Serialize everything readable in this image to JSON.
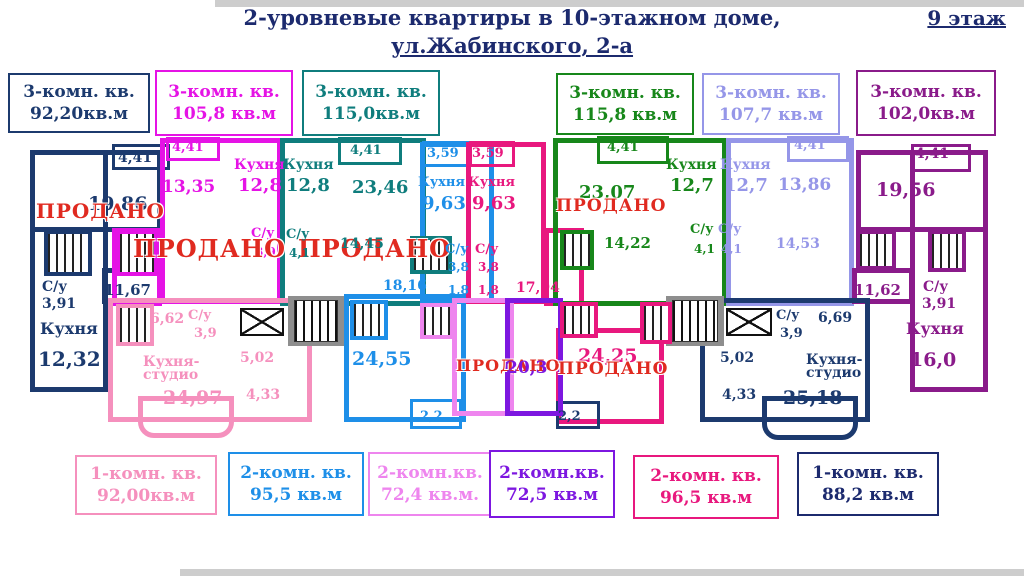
{
  "title": {
    "line1": "2-уровневые квартиры в 10-этажном доме,",
    "line2": "ул.Жабинского, 2-а",
    "floor_badge": "9 этаж"
  },
  "sold_text": "ПРОДАНО",
  "top_labels": [
    {
      "type": "3-комн. кв.",
      "area": "92,20кв.м",
      "color": "#1c3a6e"
    },
    {
      "type": "3-комн. кв.",
      "area": "105,8 кв.м",
      "color": "#e513e5"
    },
    {
      "type": "3-комн. кв.",
      "area": "115,0кв.м",
      "color": "#0f7d7d"
    },
    {
      "type": "3-комн. кв.",
      "area": "115,8 кв.м",
      "color": "#17871a"
    },
    {
      "type": "3-комн. кв.",
      "area": "107,7 кв.м",
      "color": "#9596e8"
    },
    {
      "type": "3-комн. кв.",
      "area": "102,0кв.м",
      "color": "#8a1b8a"
    }
  ],
  "bottom_labels": [
    {
      "type": "1-комн. кв.",
      "area": "92,00кв.м",
      "color": "#f590bd"
    },
    {
      "type": "2-комн. кв.",
      "area": "95,5 кв.м",
      "color": "#1e8fe8"
    },
    {
      "type": "2-комн.кв.",
      "area": "72,4 кв.м.",
      "color": "#ee85ee"
    },
    {
      "type": "2-комн.кв.",
      "area": "72,5 кв.м",
      "color": "#7d17e0"
    },
    {
      "type": "2-комн. кв.",
      "area": "96,5 кв.м",
      "color": "#e8187e"
    },
    {
      "type": "1-комн. кв.",
      "area": "88,2 кв.м",
      "color": "#1c2a6e"
    }
  ],
  "plan": {
    "colors": {
      "navy": "#1c3a6e",
      "magenta": "#e513e5",
      "teal": "#0f7d7d",
      "blue": "#1e8fe8",
      "crimson": "#e8187e",
      "green": "#17871a",
      "peri": "#9596e8",
      "purple": "#8a1b8a",
      "pink": "#f590bd",
      "orchid": "#ee85ee",
      "violet": "#7d17e0",
      "red": "#e02a20"
    },
    "labels": [
      {
        "t": "4,41",
        "c": "navy",
        "x": 118,
        "y": 150,
        "s": 14
      },
      {
        "t": "19,86",
        "c": "navy",
        "x": 88,
        "y": 193,
        "s": 19
      },
      {
        "t": "ПРОДАНО",
        "c": "red",
        "x": 36,
        "y": 199,
        "s": 20,
        "sold": true
      },
      {
        "t": "С/у",
        "c": "navy",
        "x": 42,
        "y": 279,
        "s": 14
      },
      {
        "t": "3,91",
        "c": "navy",
        "x": 42,
        "y": 296,
        "s": 14
      },
      {
        "t": "11,67",
        "c": "navy",
        "x": 104,
        "y": 281,
        "s": 15
      },
      {
        "t": "Кухня",
        "c": "navy",
        "x": 40,
        "y": 319,
        "s": 16
      },
      {
        "t": "12,32",
        "c": "navy",
        "x": 38,
        "y": 347,
        "s": 20
      },
      {
        "t": "4,41",
        "c": "magenta",
        "x": 172,
        "y": 140,
        "s": 13
      },
      {
        "t": "13,35",
        "c": "magenta",
        "x": 162,
        "y": 177,
        "s": 17
      },
      {
        "t": "Кухня",
        "c": "magenta",
        "x": 234,
        "y": 157,
        "s": 14
      },
      {
        "t": "12,8",
        "c": "magenta",
        "x": 238,
        "y": 175,
        "s": 18
      },
      {
        "t": "С/у",
        "c": "magenta",
        "x": 251,
        "y": 226,
        "s": 13
      },
      {
        "t": "3,9",
        "c": "magenta",
        "x": 255,
        "y": 245,
        "s": 12
      },
      {
        "t": "ПРОДАНО",
        "c": "red",
        "x": 133,
        "y": 234,
        "s": 24,
        "sold": true
      },
      {
        "t": "ПРОДАНО",
        "c": "red",
        "x": 298,
        "y": 234,
        "s": 24,
        "sold": true
      },
      {
        "t": "Кухня",
        "c": "teal",
        "x": 283,
        "y": 157,
        "s": 14
      },
      {
        "t": "12,8",
        "c": "teal",
        "x": 286,
        "y": 175,
        "s": 18
      },
      {
        "t": "4,41",
        "c": "teal",
        "x": 350,
        "y": 143,
        "s": 13
      },
      {
        "t": "23,46",
        "c": "teal",
        "x": 352,
        "y": 177,
        "s": 18
      },
      {
        "t": "С/у",
        "c": "teal",
        "x": 286,
        "y": 227,
        "s": 13
      },
      {
        "t": "4,1",
        "c": "teal",
        "x": 289,
        "y": 246,
        "s": 12
      },
      {
        "t": "14,45",
        "c": "teal",
        "x": 340,
        "y": 236,
        "s": 14
      },
      {
        "t": "3,59",
        "c": "blue",
        "x": 427,
        "y": 146,
        "s": 13
      },
      {
        "t": "Кухня",
        "c": "blue",
        "x": 418,
        "y": 175,
        "s": 13
      },
      {
        "t": "9,63",
        "c": "blue",
        "x": 422,
        "y": 193,
        "s": 18
      },
      {
        "t": "С/у",
        "c": "blue",
        "x": 445,
        "y": 242,
        "s": 13
      },
      {
        "t": "3,8",
        "c": "blue",
        "x": 448,
        "y": 260,
        "s": 12
      },
      {
        "t": "1,8",
        "c": "blue",
        "x": 448,
        "y": 283,
        "s": 12
      },
      {
        "t": "18,16",
        "c": "blue",
        "x": 383,
        "y": 278,
        "s": 14
      },
      {
        "t": "24,55",
        "c": "blue",
        "x": 352,
        "y": 348,
        "s": 19
      },
      {
        "t": "2,2",
        "c": "blue",
        "x": 420,
        "y": 409,
        "s": 13
      },
      {
        "t": "3,59",
        "c": "crimson",
        "x": 472,
        "y": 146,
        "s": 13
      },
      {
        "t": "Кухня",
        "c": "crimson",
        "x": 468,
        "y": 175,
        "s": 13
      },
      {
        "t": "9,63",
        "c": "crimson",
        "x": 472,
        "y": 193,
        "s": 18
      },
      {
        "t": "С/у",
        "c": "crimson",
        "x": 475,
        "y": 242,
        "s": 13
      },
      {
        "t": "3,8",
        "c": "crimson",
        "x": 478,
        "y": 260,
        "s": 12
      },
      {
        "t": "1,8",
        "c": "crimson",
        "x": 478,
        "y": 283,
        "s": 12
      },
      {
        "t": "17,94",
        "c": "crimson",
        "x": 516,
        "y": 280,
        "s": 14
      },
      {
        "t": "ПРОДАНО",
        "c": "red",
        "x": 456,
        "y": 356,
        "s": 16,
        "sold": true
      },
      {
        "t": "20,3",
        "c": "violet",
        "x": 506,
        "y": 358,
        "s": 17
      },
      {
        "t": "24,25",
        "c": "crimson",
        "x": 578,
        "y": 345,
        "s": 19
      },
      {
        "t": "ПРОДАНО",
        "c": "red",
        "x": 558,
        "y": 359,
        "s": 17,
        "sold": true
      },
      {
        "t": "2,2",
        "c": "navy",
        "x": 558,
        "y": 409,
        "s": 13
      },
      {
        "t": "4,41",
        "c": "green",
        "x": 607,
        "y": 140,
        "s": 13
      },
      {
        "t": "23,07",
        "c": "green",
        "x": 579,
        "y": 182,
        "s": 18
      },
      {
        "t": "ПРОДАНО",
        "c": "red",
        "x": 556,
        "y": 196,
        "s": 17,
        "sold": true
      },
      {
        "t": "Кухня",
        "c": "green",
        "x": 666,
        "y": 157,
        "s": 14
      },
      {
        "t": "12,7",
        "c": "green",
        "x": 670,
        "y": 175,
        "s": 18
      },
      {
        "t": "С/у",
        "c": "green",
        "x": 690,
        "y": 222,
        "s": 13
      },
      {
        "t": "4,1",
        "c": "green",
        "x": 694,
        "y": 242,
        "s": 12
      },
      {
        "t": "14,22",
        "c": "green",
        "x": 604,
        "y": 234,
        "s": 15
      },
      {
        "t": "Кухня",
        "c": "peri",
        "x": 720,
        "y": 157,
        "s": 14
      },
      {
        "t": "12,7",
        "c": "peri",
        "x": 724,
        "y": 175,
        "s": 18
      },
      {
        "t": "13,86",
        "c": "peri",
        "x": 778,
        "y": 175,
        "s": 17
      },
      {
        "t": "4,41",
        "c": "peri",
        "x": 794,
        "y": 138,
        "s": 13
      },
      {
        "t": "С/у",
        "c": "peri",
        "x": 718,
        "y": 222,
        "s": 13
      },
      {
        "t": "4,1",
        "c": "peri",
        "x": 721,
        "y": 242,
        "s": 12
      },
      {
        "t": "14,53",
        "c": "peri",
        "x": 776,
        "y": 236,
        "s": 14
      },
      {
        "t": "4,41",
        "c": "purple",
        "x": 915,
        "y": 146,
        "s": 14
      },
      {
        "t": "19,56",
        "c": "purple",
        "x": 876,
        "y": 179,
        "s": 19
      },
      {
        "t": "11,62",
        "c": "purple",
        "x": 854,
        "y": 281,
        "s": 15
      },
      {
        "t": "С/у",
        "c": "purple",
        "x": 923,
        "y": 279,
        "s": 14
      },
      {
        "t": "3,91",
        "c": "purple",
        "x": 922,
        "y": 296,
        "s": 14
      },
      {
        "t": "Кухня",
        "c": "purple",
        "x": 906,
        "y": 319,
        "s": 16
      },
      {
        "t": "16,0",
        "c": "purple",
        "x": 910,
        "y": 349,
        "s": 19
      },
      {
        "t": "6,62",
        "c": "pink",
        "x": 150,
        "y": 311,
        "s": 14
      },
      {
        "t": "С/у",
        "c": "pink",
        "x": 188,
        "y": 308,
        "s": 13
      },
      {
        "t": "3,9",
        "c": "pink",
        "x": 194,
        "y": 326,
        "s": 13
      },
      {
        "t": "Кухня-",
        "c": "pink",
        "x": 143,
        "y": 354,
        "s": 14
      },
      {
        "t": "студио",
        "c": "pink",
        "x": 143,
        "y": 367,
        "s": 14
      },
      {
        "t": "24,97",
        "c": "pink",
        "x": 163,
        "y": 387,
        "s": 19
      },
      {
        "t": "5,02",
        "c": "pink",
        "x": 240,
        "y": 350,
        "s": 14
      },
      {
        "t": "4,33",
        "c": "pink",
        "x": 246,
        "y": 387,
        "s": 14
      },
      {
        "t": "С/у",
        "c": "navy",
        "x": 776,
        "y": 308,
        "s": 13
      },
      {
        "t": "3,9",
        "c": "navy",
        "x": 780,
        "y": 326,
        "s": 13
      },
      {
        "t": "6,69",
        "c": "navy",
        "x": 818,
        "y": 310,
        "s": 14
      },
      {
        "t": "Кухня-",
        "c": "navy",
        "x": 806,
        "y": 352,
        "s": 14
      },
      {
        "t": "студио",
        "c": "navy",
        "x": 806,
        "y": 365,
        "s": 14
      },
      {
        "t": "25,18",
        "c": "navy",
        "x": 783,
        "y": 387,
        "s": 19
      },
      {
        "t": "5,02",
        "c": "navy",
        "x": 720,
        "y": 350,
        "s": 14
      },
      {
        "t": "4,33",
        "c": "navy",
        "x": 722,
        "y": 387,
        "s": 14
      }
    ]
  }
}
